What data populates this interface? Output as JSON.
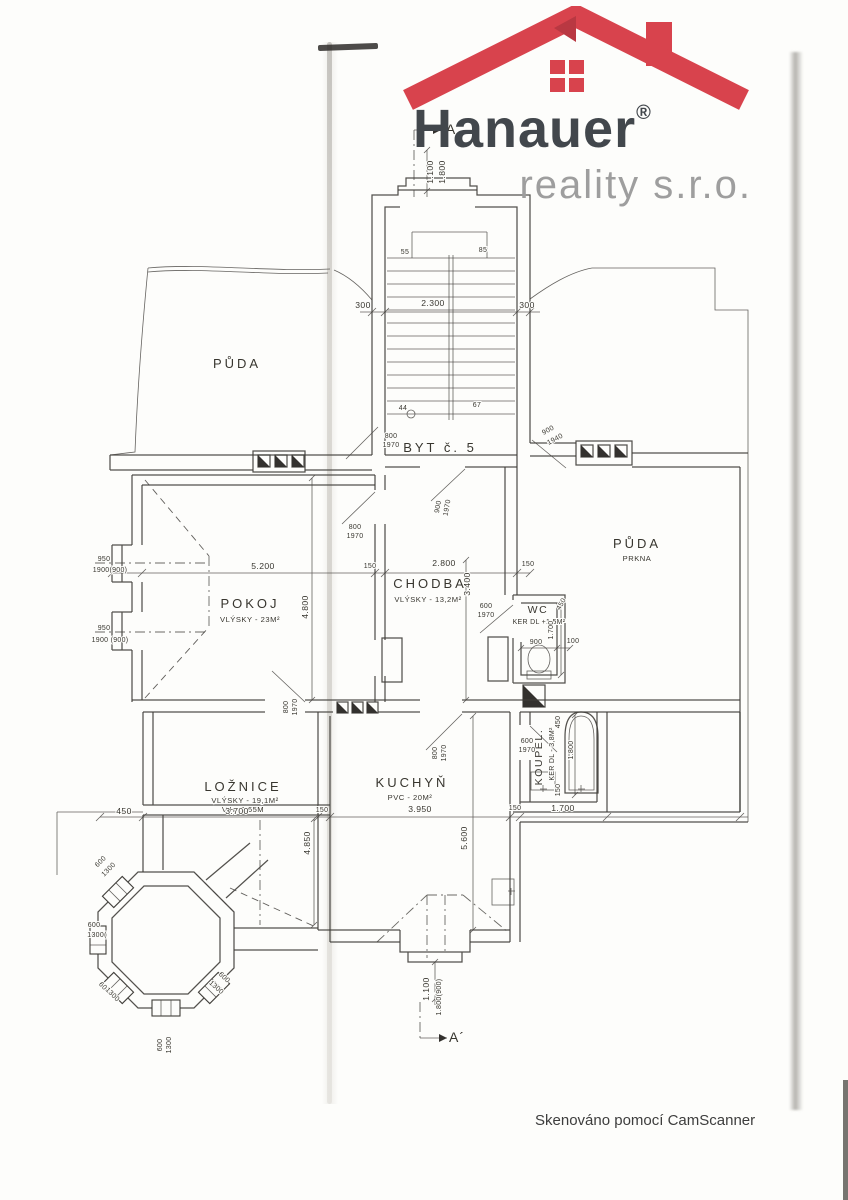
{
  "logo": {
    "brand": "Hanauer",
    "reg": "®",
    "subbrand": "reality s.r.o.",
    "roof_color": "#d8434d",
    "roof_fold_color": "#b93842",
    "brand_color": "#42474c",
    "subbrand_color": "#9e9e9e"
  },
  "footer": {
    "scanner_note": "Skenováno pomocí CamScanner"
  },
  "plan": {
    "unit": "BYT č. 5",
    "section_marks": [
      "A",
      "A´"
    ],
    "rooms": [
      {
        "name": "PŮDA",
        "detail": ""
      },
      {
        "name": "PŮDA",
        "detail": "PRKNA"
      },
      {
        "name": "POKOJ",
        "detail": "VLÝSKY - 23M²"
      },
      {
        "name": "CHODBA",
        "detail": "VLÝSKY - 13,2M²"
      },
      {
        "name": "WC",
        "detail": "KER DL  +1,5M²"
      },
      {
        "name": "LOŽNICE",
        "detail": "VLÝSKY - 19,1M²",
        "detail2": "V.H. 2,65M"
      },
      {
        "name": "KUCHYŇ",
        "detail": "PVC - 20M²"
      },
      {
        "name": "KOUPEL.",
        "detail": "KER DL - 3,8M²"
      }
    ],
    "annotations": [
      {
        "n": "room-label-puda-left",
        "t": "PŮDA",
        "x": 237,
        "y": 368,
        "c": "room"
      },
      {
        "n": "room-label-puda-right",
        "t": "PŮDA",
        "x": 637,
        "y": 548,
        "c": "room"
      },
      {
        "n": "room-sublabel-puda-right",
        "t": "PRKNA",
        "x": 637,
        "y": 561,
        "c": "sub"
      },
      {
        "n": "unit-label",
        "t": "BYT č. 5",
        "x": 440,
        "y": 452,
        "c": "room"
      },
      {
        "n": "room-label-pokoj",
        "t": "POKOJ",
        "x": 250,
        "y": 608,
        "c": "room"
      },
      {
        "n": "room-sublabel-pokoj",
        "t": "VLÝSKY - 23M²",
        "x": 250,
        "y": 622,
        "c": "sub"
      },
      {
        "n": "room-label-chodba",
        "t": "CHODBA",
        "x": 430,
        "y": 588,
        "c": "room"
      },
      {
        "n": "room-sublabel-chodba",
        "t": "VLÝSKY - 13,2M²",
        "x": 428,
        "y": 602,
        "c": "sub"
      },
      {
        "n": "room-label-wc",
        "t": "WC",
        "x": 538,
        "y": 613,
        "c": "room-sm"
      },
      {
        "n": "room-sublabel-wc",
        "t": "KER DL  +1,5M²",
        "x": 539,
        "y": 624,
        "c": "tiny"
      },
      {
        "n": "room-label-loznice",
        "t": "LOŽNICE",
        "x": 243,
        "y": 791,
        "c": "room"
      },
      {
        "n": "room-sublabel-loznice",
        "t": "VLÝSKY - 19,1M²",
        "x": 245,
        "y": 803,
        "c": "sub"
      },
      {
        "n": "room-sublabel2-loznice",
        "t": "V.H. 2,65M",
        "x": 243,
        "y": 812,
        "c": "sub"
      },
      {
        "n": "room-label-kuchyn",
        "t": "KUCHYŇ",
        "x": 412,
        "y": 787,
        "c": "room"
      },
      {
        "n": "room-sublabel-kuchyn",
        "t": "PVC - 20M²",
        "x": 410,
        "y": 800,
        "c": "sub"
      },
      {
        "n": "room-label-koupelna",
        "t": "KOUPEL.",
        "x": 542,
        "y": 757,
        "c": "room-sm",
        "r": -90
      },
      {
        "n": "room-sublabel-koupelna",
        "t": "KER DL - 3,8M²",
        "x": 554,
        "y": 754,
        "c": "tiny",
        "r": -90
      },
      {
        "t": "300",
        "x": 363,
        "y": 308,
        "c": "dim"
      },
      {
        "t": "2.300",
        "x": 433,
        "y": 306,
        "c": "dim"
      },
      {
        "t": "300",
        "x": 527,
        "y": 308,
        "c": "dim"
      },
      {
        "t": "55",
        "x": 405,
        "y": 254,
        "c": "tiny"
      },
      {
        "t": "85",
        "x": 483,
        "y": 252,
        "c": "tiny"
      },
      {
        "t": "44",
        "x": 403,
        "y": 410,
        "c": "tiny"
      },
      {
        "t": "67",
        "x": 477,
        "y": 407,
        "c": "tiny"
      },
      {
        "t": "1.100",
        "x": 433,
        "y": 172,
        "c": "dim",
        "r": -90
      },
      {
        "t": "1.800",
        "x": 445,
        "y": 172,
        "c": "dim",
        "r": -90
      },
      {
        "t": "800",
        "x": 391,
        "y": 438,
        "c": "tiny"
      },
      {
        "t": "1970",
        "x": 391,
        "y": 447,
        "c": "tiny"
      },
      {
        "t": "900",
        "x": 549,
        "y": 432,
        "c": "tiny",
        "r": -28
      },
      {
        "t": "1940",
        "x": 556,
        "y": 441,
        "c": "tiny",
        "r": -28
      },
      {
        "t": "950",
        "x": 104,
        "y": 561,
        "c": "tiny",
        "a": "end"
      },
      {
        "t": "1900(900)",
        "x": 110,
        "y": 572,
        "c": "tiny",
        "a": "end"
      },
      {
        "t": "950",
        "x": 104,
        "y": 630,
        "c": "tiny",
        "a": "end"
      },
      {
        "t": "1900 (900)",
        "x": 110,
        "y": 642,
        "c": "tiny",
        "a": "end"
      },
      {
        "t": "800",
        "x": 355,
        "y": 529,
        "c": "tiny"
      },
      {
        "t": "1970",
        "x": 355,
        "y": 538,
        "c": "tiny"
      },
      {
        "t": "900",
        "x": 440,
        "y": 507,
        "c": "tiny",
        "r": -80
      },
      {
        "t": "1970",
        "x": 449,
        "y": 508,
        "c": "tiny",
        "r": -80
      },
      {
        "t": "600",
        "x": 486,
        "y": 608,
        "c": "tiny"
      },
      {
        "t": "1970",
        "x": 486,
        "y": 617,
        "c": "tiny"
      },
      {
        "t": "800",
        "x": 288,
        "y": 707,
        "c": "tiny",
        "r": -90
      },
      {
        "t": "1970",
        "x": 297,
        "y": 707,
        "c": "tiny",
        "r": -90
      },
      {
        "t": "800",
        "x": 437,
        "y": 753,
        "c": "tiny",
        "r": -90
      },
      {
        "t": "1970",
        "x": 446,
        "y": 753,
        "c": "tiny",
        "r": -90
      },
      {
        "t": "600",
        "x": 527,
        "y": 743,
        "c": "tiny"
      },
      {
        "t": "1970",
        "x": 527,
        "y": 752,
        "c": "tiny"
      },
      {
        "t": "5.200",
        "x": 263,
        "y": 569,
        "c": "dim"
      },
      {
        "t": "150",
        "x": 370,
        "y": 568,
        "c": "tiny"
      },
      {
        "t": "2.800",
        "x": 444,
        "y": 566,
        "c": "dim"
      },
      {
        "t": "150",
        "x": 528,
        "y": 566,
        "c": "tiny"
      },
      {
        "t": "4.800",
        "x": 308,
        "y": 607,
        "c": "dim",
        "r": -90
      },
      {
        "t": "3.400",
        "x": 470,
        "y": 584,
        "c": "dim",
        "r": -90
      },
      {
        "t": "900",
        "x": 536,
        "y": 644,
        "c": "tiny"
      },
      {
        "t": "100",
        "x": 573,
        "y": 643,
        "c": "tiny"
      },
      {
        "t": "1.700",
        "x": 553,
        "y": 630,
        "c": "tiny",
        "r": -90
      },
      {
        "t": "450",
        "x": 563,
        "y": 605,
        "c": "tiny",
        "r": -60
      },
      {
        "t": "450",
        "x": 124,
        "y": 814,
        "c": "dim"
      },
      {
        "t": "3.700",
        "x": 237,
        "y": 814,
        "c": "dim"
      },
      {
        "t": "150",
        "x": 322,
        "y": 812,
        "c": "tiny"
      },
      {
        "t": "4.850",
        "x": 310,
        "y": 843,
        "c": "dim",
        "r": -90
      },
      {
        "t": "3.950",
        "x": 420,
        "y": 812,
        "c": "dim"
      },
      {
        "t": "150",
        "x": 515,
        "y": 810,
        "c": "tiny"
      },
      {
        "t": "1.700",
        "x": 563,
        "y": 811,
        "c": "dim"
      },
      {
        "t": "5.600",
        "x": 467,
        "y": 838,
        "c": "dim",
        "r": -90
      },
      {
        "t": "450",
        "x": 560,
        "y": 722,
        "c": "tiny",
        "r": -90
      },
      {
        "t": "1.800",
        "x": 573,
        "y": 750,
        "c": "tiny",
        "r": -90
      },
      {
        "t": "150",
        "x": 560,
        "y": 790,
        "c": "tiny",
        "r": -90
      },
      {
        "t": "1.100",
        "x": 429,
        "y": 989,
        "c": "dim",
        "r": -90
      },
      {
        "t": "1.800(900)",
        "x": 441,
        "y": 997,
        "c": "tiny",
        "r": -90
      },
      {
        "t": "600",
        "x": 102,
        "y": 863,
        "c": "tiny",
        "r": -45
      },
      {
        "t": "1300",
        "x": 110,
        "y": 871,
        "c": "tiny",
        "r": -45
      },
      {
        "t": "600",
        "x": 94,
        "y": 927,
        "c": "tiny",
        "a": "end"
      },
      {
        "t": "1300(",
        "x": 97,
        "y": 937,
        "c": "tiny",
        "a": "end"
      },
      {
        "t": "600",
        "x": 103,
        "y": 989,
        "c": "tiny",
        "r": 45
      },
      {
        "t": "1300",
        "x": 111,
        "y": 996,
        "c": "tiny",
        "r": 45
      },
      {
        "t": "600",
        "x": 162,
        "y": 1045,
        "c": "tiny",
        "r": -90
      },
      {
        "t": "1300",
        "x": 171,
        "y": 1045,
        "c": "tiny",
        "r": -90
      },
      {
        "t": "600",
        "x": 223,
        "y": 979,
        "c": "tiny",
        "r": 42
      },
      {
        "t": "1300",
        "x": 215,
        "y": 989,
        "c": "tiny",
        "r": 42
      },
      {
        "n": "section-label-a",
        "t": "A",
        "x": 451,
        "y": 134,
        "c": "section"
      },
      {
        "n": "section-label-a-prime",
        "t": "A´",
        "x": 457,
        "y": 1042,
        "c": "section"
      }
    ]
  }
}
